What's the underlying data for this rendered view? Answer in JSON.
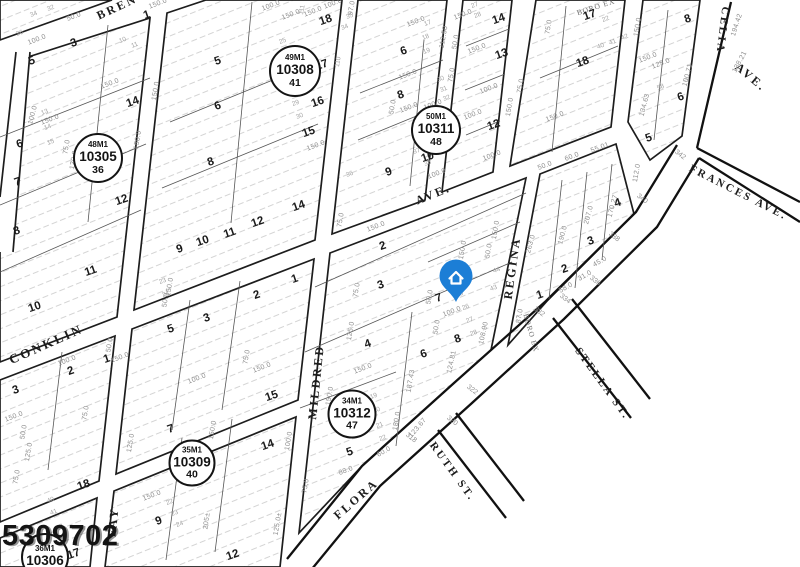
{
  "map": {
    "stamp": "5309702",
    "pin": {
      "x": 456,
      "y": 302,
      "color": "#1c7ed6",
      "icon": "house-icon"
    },
    "streets": [
      {
        "label": "BREN",
        "x": 117,
        "y": 7,
        "rot": -25
      },
      {
        "label": "CONKLIN",
        "x": 46,
        "y": 344,
        "rot": -24,
        "size": 13
      },
      {
        "label": "FAY",
        "x": 113,
        "y": 522,
        "rot": -84
      },
      {
        "label": "MILDRED",
        "x": 316,
        "y": 382,
        "rot": -84
      },
      {
        "label": "AVE.",
        "x": 433,
        "y": 194,
        "rot": -22
      },
      {
        "label": "REGINA",
        "x": 512,
        "y": 268,
        "rot": -82
      },
      {
        "label": "FLORA",
        "x": 356,
        "y": 499,
        "rot": -41
      },
      {
        "label": "RUTH ST.",
        "x": 452,
        "y": 472,
        "rot": 54,
        "size": 11
      },
      {
        "label": "STELLA ST.",
        "x": 602,
        "y": 384,
        "rot": 54,
        "size": 11
      },
      {
        "label": "FRANCES AVE.",
        "x": 738,
        "y": 193,
        "rot": 27,
        "size": 11
      },
      {
        "label": "CELIA",
        "x": 722,
        "y": 30,
        "rot": 97,
        "size": 11
      },
      {
        "label": "AVE.",
        "x": 751,
        "y": 77,
        "rot": 40
      },
      {
        "label": "BORO EX",
        "x": 596,
        "y": 7,
        "rot": -18,
        "small": true
      },
      {
        "label": "BORO EX",
        "x": 531,
        "y": 333,
        "rot": 74,
        "small": true
      }
    ],
    "blocks": [
      {
        "m": "48M1",
        "num": "10305",
        "sub": "36",
        "x": 98,
        "y": 158,
        "d": 46
      },
      {
        "m": "49M1",
        "num": "10308",
        "sub": "41",
        "x": 295,
        "y": 71,
        "d": 48
      },
      {
        "m": "50M1",
        "num": "10311",
        "sub": "48",
        "x": 436,
        "y": 130,
        "d": 46
      },
      {
        "m": "34M1",
        "num": "10312",
        "sub": "47",
        "x": 352,
        "y": 414,
        "d": 45
      },
      {
        "m": "35M1",
        "num": "10309",
        "sub": "40",
        "x": 192,
        "y": 463,
        "d": 43
      },
      {
        "m": "36M1",
        "num": "10306",
        "sub": "",
        "x": 45,
        "y": 557,
        "d": 44
      }
    ],
    "lots": [
      {
        "n": "1",
        "x": 147,
        "y": 16
      },
      {
        "n": "3",
        "x": 74,
        "y": 44
      },
      {
        "n": "5",
        "x": 32,
        "y": 62
      },
      {
        "n": "14",
        "x": 133,
        "y": 103
      },
      {
        "n": "6",
        "x": 20,
        "y": 145
      },
      {
        "n": "7",
        "x": 18,
        "y": 183
      },
      {
        "n": "8",
        "x": 17,
        "y": 232
      },
      {
        "n": "12",
        "x": 122,
        "y": 201
      },
      {
        "n": "11",
        "x": 91,
        "y": 272
      },
      {
        "n": "10",
        "x": 35,
        "y": 308
      },
      {
        "n": "5",
        "x": 218,
        "y": 62
      },
      {
        "n": "6",
        "x": 218,
        "y": 107
      },
      {
        "n": "8",
        "x": 211,
        "y": 163
      },
      {
        "n": "18",
        "x": 326,
        "y": 21
      },
      {
        "n": "17",
        "x": 322,
        "y": 66
      },
      {
        "n": "16",
        "x": 318,
        "y": 103
      },
      {
        "n": "15",
        "x": 309,
        "y": 133
      },
      {
        "n": "14",
        "x": 299,
        "y": 207
      },
      {
        "n": "12",
        "x": 258,
        "y": 223
      },
      {
        "n": "11",
        "x": 230,
        "y": 234
      },
      {
        "n": "10",
        "x": 203,
        "y": 242
      },
      {
        "n": "9",
        "x": 180,
        "y": 250
      },
      {
        "n": "6",
        "x": 404,
        "y": 52
      },
      {
        "n": "8",
        "x": 401,
        "y": 96
      },
      {
        "n": "9",
        "x": 389,
        "y": 173
      },
      {
        "n": "10",
        "x": 428,
        "y": 158
      },
      {
        "n": "14",
        "x": 499,
        "y": 20
      },
      {
        "n": "13",
        "x": 502,
        "y": 55
      },
      {
        "n": "12",
        "x": 494,
        "y": 126
      },
      {
        "n": "17",
        "x": 590,
        "y": 16
      },
      {
        "n": "18",
        "x": 583,
        "y": 63
      },
      {
        "n": "8",
        "x": 688,
        "y": 20
      },
      {
        "n": "6",
        "x": 681,
        "y": 98
      },
      {
        "n": "5",
        "x": 649,
        "y": 139
      },
      {
        "n": "4",
        "x": 618,
        "y": 204
      },
      {
        "n": "3",
        "x": 591,
        "y": 242
      },
      {
        "n": "2",
        "x": 565,
        "y": 270
      },
      {
        "n": "1",
        "x": 540,
        "y": 296
      },
      {
        "n": "1",
        "x": 295,
        "y": 280
      },
      {
        "n": "2",
        "x": 257,
        "y": 296
      },
      {
        "n": "3",
        "x": 207,
        "y": 319
      },
      {
        "n": "5",
        "x": 171,
        "y": 330
      },
      {
        "n": "15",
        "x": 272,
        "y": 397
      },
      {
        "n": "7",
        "x": 171,
        "y": 430
      },
      {
        "n": "2",
        "x": 383,
        "y": 247
      },
      {
        "n": "3",
        "x": 381,
        "y": 286
      },
      {
        "n": "7",
        "x": 439,
        "y": 299
      },
      {
        "n": "4",
        "x": 368,
        "y": 345
      },
      {
        "n": "8",
        "x": 458,
        "y": 340
      },
      {
        "n": "6",
        "x": 424,
        "y": 355
      },
      {
        "n": "5",
        "x": 350,
        "y": 453
      },
      {
        "n": "1",
        "x": 107,
        "y": 360
      },
      {
        "n": "2",
        "x": 71,
        "y": 372
      },
      {
        "n": "3",
        "x": 16,
        "y": 391
      },
      {
        "n": "18",
        "x": 84,
        "y": 486
      },
      {
        "n": "17",
        "x": 74,
        "y": 555
      },
      {
        "n": "9",
        "x": 159,
        "y": 522
      },
      {
        "n": "14",
        "x": 268,
        "y": 446
      },
      {
        "n": "12",
        "x": 233,
        "y": 556
      }
    ],
    "dims": [
      {
        "t": "150.0",
        "x": 158,
        "y": 4
      },
      {
        "t": "50.0",
        "x": 74,
        "y": 17
      },
      {
        "t": "34",
        "x": 34,
        "y": 15,
        "c": "t"
      },
      {
        "t": "32",
        "x": 51,
        "y": 9,
        "c": "t"
      },
      {
        "t": "36",
        "x": 20,
        "y": 34,
        "c": "t"
      },
      {
        "t": "100.0",
        "x": 37,
        "y": 40
      },
      {
        "t": "150.0",
        "x": 110,
        "y": 84
      },
      {
        "t": "100.0",
        "x": 33,
        "y": 115,
        "r": -75
      },
      {
        "t": "150.0",
        "x": 50,
        "y": 120
      },
      {
        "t": "75.0",
        "x": 67,
        "y": 147,
        "r": -80
      },
      {
        "t": "120.0",
        "x": 74,
        "y": 160,
        "r": -80
      },
      {
        "t": "150.0",
        "x": 156,
        "y": 91,
        "r": -80
      },
      {
        "t": "150.0",
        "x": 138,
        "y": 140,
        "r": -80
      },
      {
        "t": "13",
        "x": 45,
        "y": 113,
        "c": "t"
      },
      {
        "t": "14",
        "x": 48,
        "y": 128,
        "c": "t"
      },
      {
        "t": "15",
        "x": 51,
        "y": 143,
        "c": "t"
      },
      {
        "t": "10",
        "x": 123,
        "y": 41,
        "c": "t"
      },
      {
        "t": "11",
        "x": 135,
        "y": 46,
        "c": "t"
      },
      {
        "t": "100.0",
        "x": 271,
        "y": 6
      },
      {
        "t": "150.0",
        "x": 291,
        "y": 15
      },
      {
        "t": "111",
        "x": 303,
        "y": 10,
        "r": -80,
        "c": "t"
      },
      {
        "t": "97.0",
        "x": 352,
        "y": 8,
        "r": -80
      },
      {
        "t": "100.0",
        "x": 333,
        "y": 4
      },
      {
        "t": "150.0",
        "x": 313,
        "y": 12
      },
      {
        "t": "25",
        "x": 283,
        "y": 42,
        "c": "t"
      },
      {
        "t": "26",
        "x": 287,
        "y": 52,
        "c": "t"
      },
      {
        "t": "110",
        "x": 339,
        "y": 62,
        "r": -80,
        "c": "t"
      },
      {
        "t": "150.0",
        "x": 316,
        "y": 146
      },
      {
        "t": "29",
        "x": 296,
        "y": 104,
        "c": "t"
      },
      {
        "t": "30",
        "x": 300,
        "y": 117,
        "c": "t"
      },
      {
        "t": "150.0",
        "x": 416,
        "y": 22
      },
      {
        "t": "17",
        "x": 428,
        "y": 24,
        "c": "t"
      },
      {
        "t": "18",
        "x": 426,
        "y": 38,
        "c": "t"
      },
      {
        "t": "19",
        "x": 427,
        "y": 52,
        "c": "t"
      },
      {
        "t": "112.50",
        "x": 444,
        "y": 37,
        "r": -80
      },
      {
        "t": "50.0",
        "x": 456,
        "y": 42,
        "r": -80
      },
      {
        "t": "150.0",
        "x": 463,
        "y": 15
      },
      {
        "t": "27",
        "x": 475,
        "y": 6,
        "c": "t"
      },
      {
        "t": "28",
        "x": 478,
        "y": 16,
        "c": "t"
      },
      {
        "t": "150.0",
        "x": 408,
        "y": 75
      },
      {
        "t": "50.0",
        "x": 393,
        "y": 107,
        "r": -80
      },
      {
        "t": "150.0",
        "x": 409,
        "y": 108
      },
      {
        "t": "100.0",
        "x": 433,
        "y": 105
      },
      {
        "t": "75.0",
        "x": 452,
        "y": 75,
        "r": -80
      },
      {
        "t": "30",
        "x": 441,
        "y": 80,
        "c": "t"
      },
      {
        "t": "31",
        "x": 444,
        "y": 90,
        "c": "t"
      },
      {
        "t": "32",
        "x": 447,
        "y": 99,
        "c": "t"
      },
      {
        "t": "34",
        "x": 345,
        "y": 28,
        "c": "t"
      },
      {
        "t": "35",
        "x": 350,
        "y": 17,
        "c": "t"
      },
      {
        "t": "36",
        "x": 350,
        "y": 175,
        "c": "t"
      },
      {
        "t": "37",
        "x": 417,
        "y": 152,
        "c": "t"
      },
      {
        "t": "38",
        "x": 428,
        "y": 164,
        "c": "t"
      },
      {
        "t": "100.0",
        "x": 437,
        "y": 174
      },
      {
        "t": "100.0",
        "x": 473,
        "y": 115
      },
      {
        "t": "150.0",
        "x": 477,
        "y": 49
      },
      {
        "t": "100.0",
        "x": 489,
        "y": 89
      },
      {
        "t": "75.0",
        "x": 521,
        "y": 86,
        "r": -80
      },
      {
        "t": "150.0",
        "x": 510,
        "y": 107,
        "r": -80
      },
      {
        "t": "100.0",
        "x": 492,
        "y": 156
      },
      {
        "t": "22",
        "x": 606,
        "y": 20,
        "c": "t"
      },
      {
        "t": "75.0",
        "x": 549,
        "y": 27,
        "r": -80
      },
      {
        "t": "150.0",
        "x": 638,
        "y": 27,
        "r": -80
      },
      {
        "t": "40",
        "x": 601,
        "y": 47,
        "c": "t"
      },
      {
        "t": "41",
        "x": 613,
        "y": 43,
        "c": "t"
      },
      {
        "t": "42",
        "x": 625,
        "y": 38,
        "c": "t"
      },
      {
        "t": "150.0",
        "x": 555,
        "y": 117
      },
      {
        "t": "55.01",
        "x": 600,
        "y": 148
      },
      {
        "t": "50.0",
        "x": 545,
        "y": 166
      },
      {
        "t": "60.0",
        "x": 572,
        "y": 157
      },
      {
        "t": "112.0",
        "x": 637,
        "y": 173,
        "r": -80
      },
      {
        "t": "150.0",
        "x": 648,
        "y": 58
      },
      {
        "t": "125.0",
        "x": 661,
        "y": 64
      },
      {
        "t": "100.71",
        "x": 688,
        "y": 75,
        "r": -75
      },
      {
        "t": "134.63",
        "x": 645,
        "y": 105,
        "r": -75
      },
      {
        "t": "58",
        "x": 661,
        "y": 88,
        "c": "t"
      },
      {
        "t": "194.42",
        "x": 737,
        "y": 25,
        "r": -72
      },
      {
        "t": "138.21",
        "x": 740,
        "y": 62,
        "r": -62
      },
      {
        "t": "342",
        "x": 680,
        "y": 155,
        "r": 38,
        "c": "s"
      },
      {
        "t": "150.0",
        "x": 496,
        "y": 230,
        "r": -80
      },
      {
        "t": "50.0",
        "x": 489,
        "y": 251,
        "r": -80
      },
      {
        "t": "190.0",
        "x": 563,
        "y": 235,
        "r": -75
      },
      {
        "t": "207.0",
        "x": 589,
        "y": 215,
        "r": -75
      },
      {
        "t": "170.27",
        "x": 613,
        "y": 206,
        "r": -75
      },
      {
        "t": "263.0",
        "x": 531,
        "y": 244,
        "r": -75
      },
      {
        "t": "87.0",
        "x": 520,
        "y": 316,
        "r": -80
      },
      {
        "t": "58.0",
        "x": 566,
        "y": 288,
        "r": -30
      },
      {
        "t": "31.0",
        "x": 585,
        "y": 276,
        "r": -30
      },
      {
        "t": "45.0",
        "x": 600,
        "y": 262,
        "r": -30
      },
      {
        "t": "43",
        "x": 494,
        "y": 289,
        "c": "t"
      },
      {
        "t": "44",
        "x": 497,
        "y": 271,
        "c": "t"
      },
      {
        "t": "318",
        "x": 411,
        "y": 438,
        "r": 38,
        "c": "s"
      },
      {
        "t": "320",
        "x": 452,
        "y": 421,
        "r": 38,
        "c": "s"
      },
      {
        "t": "322",
        "x": 472,
        "y": 390,
        "r": 38,
        "c": "s"
      },
      {
        "t": "332",
        "x": 539,
        "y": 312,
        "r": 38,
        "c": "s"
      },
      {
        "t": "334",
        "x": 565,
        "y": 299,
        "r": 38,
        "c": "s"
      },
      {
        "t": "336",
        "x": 595,
        "y": 281,
        "r": 38,
        "c": "s"
      },
      {
        "t": "338",
        "x": 614,
        "y": 237,
        "r": 38,
        "c": "s"
      },
      {
        "t": "340",
        "x": 642,
        "y": 199,
        "r": 38,
        "c": "s"
      },
      {
        "t": "108.90",
        "x": 484,
        "y": 333,
        "r": -78
      },
      {
        "t": "124.81",
        "x": 452,
        "y": 362,
        "r": -78
      },
      {
        "t": "123.67",
        "x": 418,
        "y": 428,
        "r": -50
      },
      {
        "t": "150.0",
        "x": 463,
        "y": 250,
        "r": -80
      },
      {
        "t": "50.0",
        "x": 430,
        "y": 297,
        "r": -80
      },
      {
        "t": "100.0",
        "x": 452,
        "y": 312
      },
      {
        "t": "50.0",
        "x": 437,
        "y": 327,
        "r": -80
      },
      {
        "t": "25",
        "x": 460,
        "y": 295,
        "c": "t"
      },
      {
        "t": "26",
        "x": 466,
        "y": 308,
        "c": "t"
      },
      {
        "t": "27",
        "x": 470,
        "y": 321,
        "c": "t"
      },
      {
        "t": "28",
        "x": 474,
        "y": 334,
        "c": "t"
      },
      {
        "t": "150.0",
        "x": 376,
        "y": 227
      },
      {
        "t": "75.0",
        "x": 341,
        "y": 220,
        "r": -80
      },
      {
        "t": "75.0",
        "x": 357,
        "y": 290,
        "r": -80
      },
      {
        "t": "125.0",
        "x": 351,
        "y": 331,
        "r": -80
      },
      {
        "t": "150.0",
        "x": 363,
        "y": 369
      },
      {
        "t": "187.43",
        "x": 411,
        "y": 381,
        "r": -80
      },
      {
        "t": "180.0",
        "x": 397,
        "y": 421,
        "r": -80
      },
      {
        "t": "60.0",
        "x": 384,
        "y": 452,
        "r": -30
      },
      {
        "t": "88.0",
        "x": 346,
        "y": 471
      },
      {
        "t": "75.0",
        "x": 306,
        "y": 486,
        "r": -80
      },
      {
        "t": "125.0±",
        "x": 278,
        "y": 524,
        "r": -80
      },
      {
        "t": "150.0",
        "x": 330,
        "y": 396,
        "r": -80
      },
      {
        "t": "100.0",
        "x": 289,
        "y": 441,
        "r": -80
      },
      {
        "t": "19",
        "x": 374,
        "y": 397,
        "c": "t"
      },
      {
        "t": "20",
        "x": 377,
        "y": 411,
        "c": "t"
      },
      {
        "t": "21",
        "x": 380,
        "y": 426,
        "c": "t"
      },
      {
        "t": "22",
        "x": 383,
        "y": 439,
        "c": "t"
      },
      {
        "t": "100.0",
        "x": 67,
        "y": 361
      },
      {
        "t": "50.0",
        "x": 110,
        "y": 345,
        "r": -80
      },
      {
        "t": "150.0",
        "x": 120,
        "y": 358
      },
      {
        "t": "100.0",
        "x": 197,
        "y": 379
      },
      {
        "t": "75.0",
        "x": 247,
        "y": 357,
        "r": -80
      },
      {
        "t": "150.0",
        "x": 262,
        "y": 368
      },
      {
        "t": "50.0",
        "x": 166,
        "y": 300,
        "r": -80
      },
      {
        "t": "150.0",
        "x": 170,
        "y": 287,
        "r": -80
      },
      {
        "t": "23",
        "x": 163,
        "y": 282,
        "c": "t"
      },
      {
        "t": "24",
        "x": 166,
        "y": 295,
        "c": "t"
      },
      {
        "t": "150.0",
        "x": 14,
        "y": 417
      },
      {
        "t": "50.0",
        "x": 24,
        "y": 432,
        "r": -80
      },
      {
        "t": "125.0",
        "x": 29,
        "y": 452,
        "r": -80
      },
      {
        "t": "75.0",
        "x": 17,
        "y": 477,
        "r": -80
      },
      {
        "t": "75.0",
        "x": 86,
        "y": 413,
        "r": -80
      },
      {
        "t": "40",
        "x": 51,
        "y": 501,
        "c": "t"
      },
      {
        "t": "41",
        "x": 54,
        "y": 513,
        "c": "t"
      },
      {
        "t": "42",
        "x": 60,
        "y": 528,
        "c": "t"
      },
      {
        "t": "150.0",
        "x": 152,
        "y": 496
      },
      {
        "t": "125.0",
        "x": 131,
        "y": 443,
        "r": -80
      },
      {
        "t": "205±",
        "x": 207,
        "y": 521,
        "r": -82
      },
      {
        "t": "150.0",
        "x": 213,
        "y": 430,
        "r": -80
      },
      {
        "t": "22",
        "x": 170,
        "y": 503,
        "c": "t"
      },
      {
        "t": "23",
        "x": 175,
        "y": 514,
        "c": "t"
      },
      {
        "t": "24",
        "x": 180,
        "y": 525,
        "c": "t"
      }
    ]
  }
}
